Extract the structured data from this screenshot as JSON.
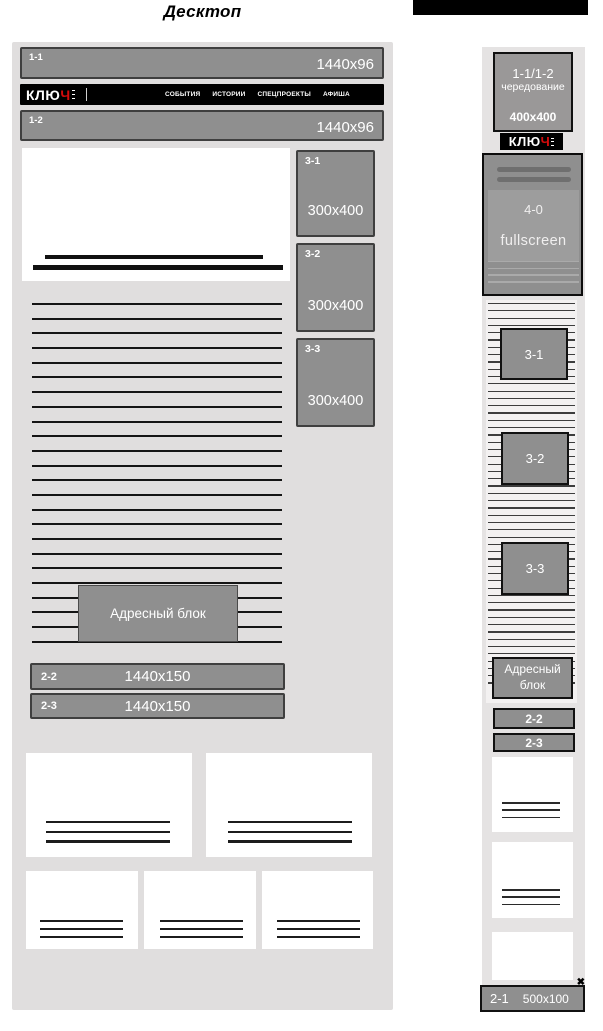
{
  "page": {
    "title_desktop": "Десктоп"
  },
  "colors": {
    "accent_red": "#d40b0b",
    "banner_gray": "#8f8f8f",
    "container_gray": "#e0dede",
    "mobile_column_gray": "#e5e3e3"
  },
  "logo": {
    "text_main": "КЛЮ",
    "text_accent": "Ч"
  },
  "desktop": {
    "banner_1_1": {
      "label": "1-1",
      "size": "1440x96"
    },
    "nav_items": [
      {
        "label": "СОБЫТИЯ"
      },
      {
        "label": "ИСТОРИИ"
      },
      {
        "label": "СПЕЦПРОЕКТЫ"
      },
      {
        "label": "АФИША"
      }
    ],
    "banner_1_2": {
      "label": "1-2",
      "size": "1440x96"
    },
    "sidebar_banners": [
      {
        "label": "3-1",
        "size": "300x400"
      },
      {
        "label": "3-2",
        "size": "300x400"
      },
      {
        "label": "3-3",
        "size": "300x400"
      }
    ],
    "address_block": {
      "label": "Адресный блок"
    },
    "wide_banners": [
      {
        "label": "2-2",
        "size": "1440x150"
      },
      {
        "label": "2-3",
        "size": "1440x150"
      }
    ]
  },
  "mobile": {
    "rotation_banner": {
      "label": "1-1/1-2",
      "mode": "чередование",
      "size": "400x400"
    },
    "fullscreen_banner": {
      "label": "4-0",
      "mode": "fullscreen"
    },
    "inline_banners": [
      {
        "label": "3-1"
      },
      {
        "label": "3-2"
      },
      {
        "label": "3-3"
      }
    ],
    "address_block": {
      "line1": "Адресный",
      "line2": "блок"
    },
    "wide_banners": [
      {
        "label": "2-2"
      },
      {
        "label": "2-3"
      }
    ],
    "sticky_banner": {
      "label": "2-1",
      "size": "500x100",
      "close_icon": "✖"
    }
  }
}
